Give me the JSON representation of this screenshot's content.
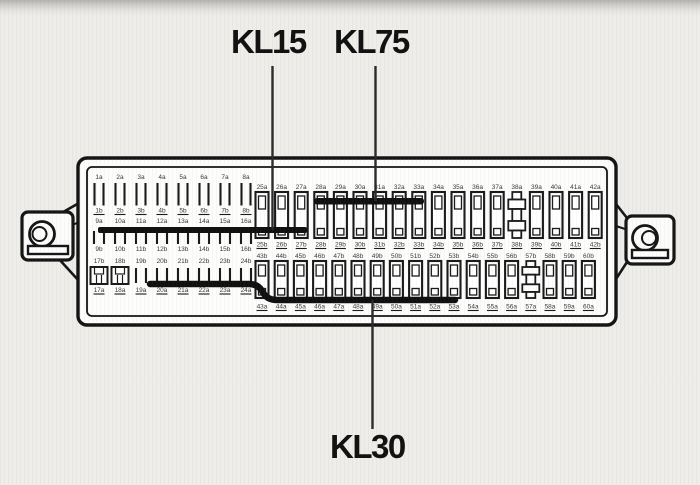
{
  "terminals": {
    "kl15": "KL15",
    "kl75": "KL75",
    "kl30": "KL30"
  },
  "colors": {
    "ink": "#1a1a1a",
    "paper": "#eeede9",
    "bus_bar": "#101010"
  },
  "fuse_box": {
    "left_section": {
      "rows": [
        {
          "top": [
            "1a",
            "2a",
            "3a",
            "4a",
            "5a",
            "6a",
            "7a",
            "8a"
          ],
          "bottom": [
            "1b",
            "2b",
            "3b",
            "4b",
            "5b",
            "6b",
            "7b",
            "8b"
          ]
        },
        {
          "top": [
            "9a",
            "10a",
            "11a",
            "12a",
            "13a",
            "14a",
            "15a",
            "16a"
          ],
          "bottom": [
            "9b",
            "10b",
            "11b",
            "12b",
            "13b",
            "14b",
            "15b",
            "16b"
          ],
          "bus": "KL15"
        },
        {
          "top": [
            "17b",
            "18b",
            "19b",
            "20b",
            "21b",
            "22b",
            "23b",
            "24b"
          ],
          "bottom": [
            "17a",
            "18a",
            "19a",
            "20a",
            "21a",
            "22a",
            "23a",
            "24a"
          ],
          "bus": "KL30",
          "socket_columns": [
            "17b",
            "18b"
          ]
        }
      ]
    },
    "right_section": {
      "rows": [
        {
          "top": [
            "25a",
            "26a",
            "27a",
            "28a",
            "29a",
            "30a",
            "31a",
            "32a",
            "33a",
            "34a",
            "35a",
            "36a",
            "37a",
            "38a",
            "39a",
            "40a",
            "41a",
            "42a"
          ],
          "bottom": [
            "25b",
            "26b",
            "27b",
            "28b",
            "29b",
            "30b",
            "31b",
            "32b",
            "33b",
            "34b",
            "35b",
            "36b",
            "37b",
            "38b",
            "39b",
            "40b",
            "41b",
            "42b"
          ],
          "bus": "KL75",
          "relay_column": "38a"
        },
        {
          "top": [
            "43b",
            "44b",
            "45b",
            "46b",
            "47b",
            "48b",
            "49b",
            "50b",
            "51b",
            "52b",
            "53b",
            "54b",
            "55b",
            "56b",
            "57b",
            "58b",
            "59b",
            "60b"
          ],
          "bottom": [
            "43a",
            "44a",
            "45a",
            "46a",
            "47a",
            "48a",
            "49a",
            "50a",
            "51a",
            "52a",
            "53a",
            "54a",
            "55a",
            "56a",
            "57a",
            "58a",
            "59a",
            "60a"
          ],
          "bus": "KL30",
          "relay_column": "57b"
        }
      ]
    }
  }
}
